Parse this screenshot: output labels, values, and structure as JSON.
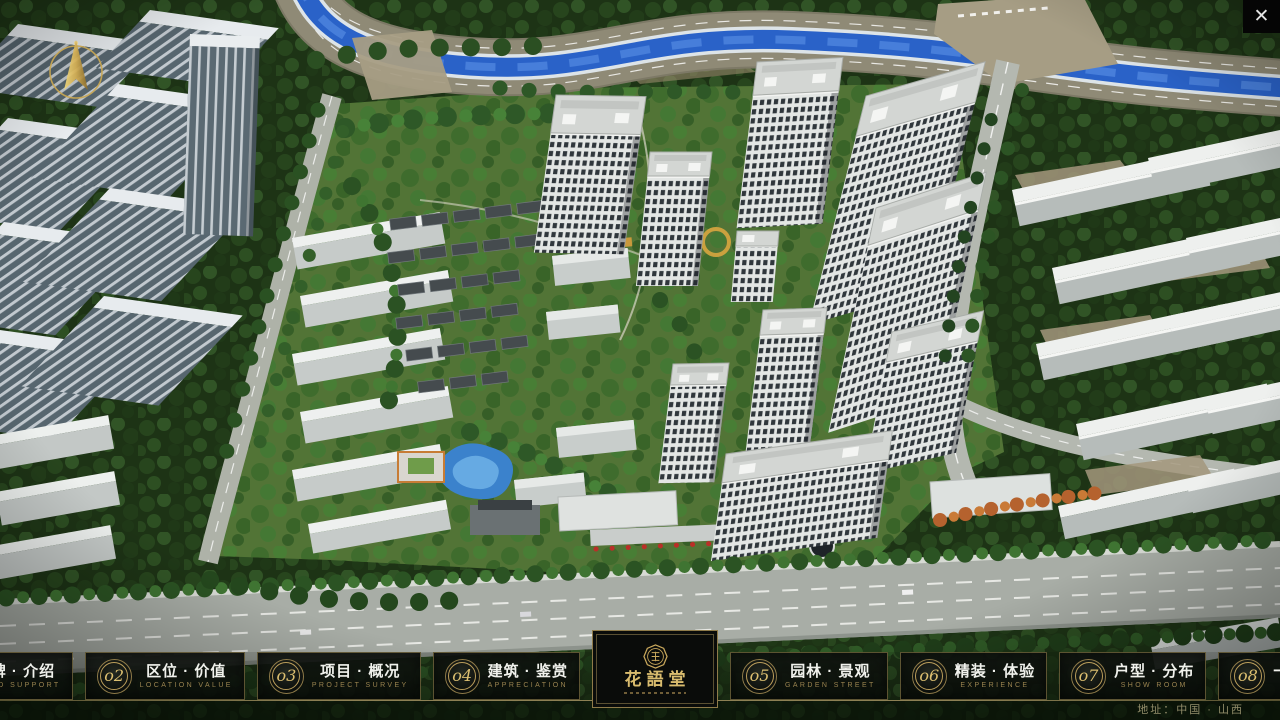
{
  "window": {
    "close_glyph": "✕"
  },
  "logo": {
    "name": "花語堂"
  },
  "footer": {
    "address": "地址：中国 · 山西"
  },
  "nav": {
    "items": [
      {
        "num": "o1",
        "title": "品牌 · 介绍",
        "subtitle": "BRAND SUPPORT"
      },
      {
        "num": "o2",
        "title": "区位 · 价值",
        "subtitle": "LOCATION VALUE"
      },
      {
        "num": "o3",
        "title": "项目 · 概况",
        "subtitle": "PROJECT SURVEY"
      },
      {
        "num": "o4",
        "title": "建筑 · 鉴赏",
        "subtitle": "APPRECIATION"
      },
      {
        "num": "o5",
        "title": "园林 · 景观",
        "subtitle": "GARDEN STREET"
      },
      {
        "num": "o6",
        "title": "精装 · 体验",
        "subtitle": "EXPERIENCE"
      },
      {
        "num": "o7",
        "title": "户型 · 分布",
        "subtitle": "SHOW ROOM"
      },
      {
        "num": "o8",
        "title": "一房 · 一景",
        "subtitle": "COMMUNITY"
      }
    ]
  },
  "colors": {
    "gold": "#c9a85c",
    "panel": "#0c0f0c",
    "river": "#2a62c8"
  }
}
